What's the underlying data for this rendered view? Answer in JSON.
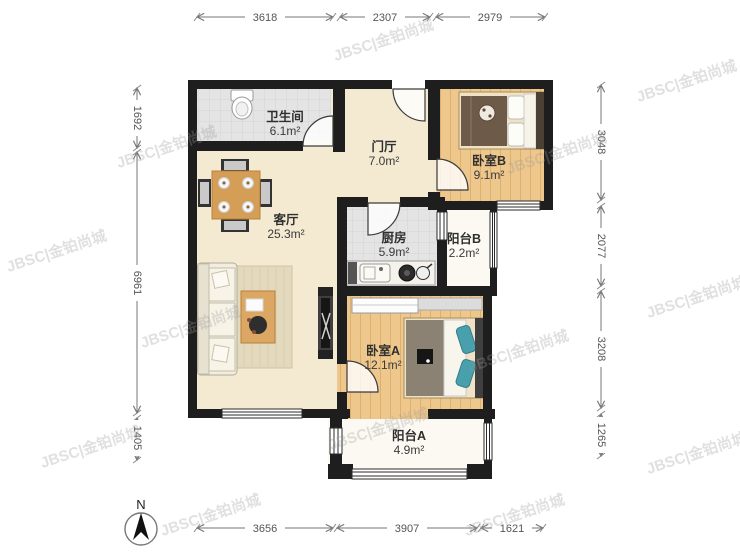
{
  "floorplan": {
    "watermark_text": "JBSC|金铂尚城",
    "north_label": "N",
    "rooms": [
      {
        "name": "卫生间",
        "area": "6.1m²"
      },
      {
        "name": "门厅",
        "area": "7.0m²"
      },
      {
        "name": "卧室B",
        "area": "9.1m²"
      },
      {
        "name": "客厅",
        "area": "25.3m²"
      },
      {
        "name": "厨房",
        "area": "5.9m²"
      },
      {
        "name": "阳台B",
        "area": "2.2m²"
      },
      {
        "name": "卧室A",
        "area": "12.1m²"
      },
      {
        "name": "阳台A",
        "area": "4.9m²"
      }
    ],
    "dimensions_mm": {
      "top": [
        "3618",
        "2307",
        "2979"
      ],
      "bottom": [
        "3656",
        "3907",
        "1621"
      ],
      "left": [
        "1692",
        "6961",
        "1405"
      ],
      "right": [
        "3048",
        "2077",
        "3208",
        "1265"
      ]
    },
    "colors": {
      "wall": "#1e1e1e",
      "floor_main": "#f4ead2",
      "floor_wood": "#edc78c",
      "floor_tile": "#e4e4e4",
      "floor_balcony": "#fbf9f1"
    }
  }
}
